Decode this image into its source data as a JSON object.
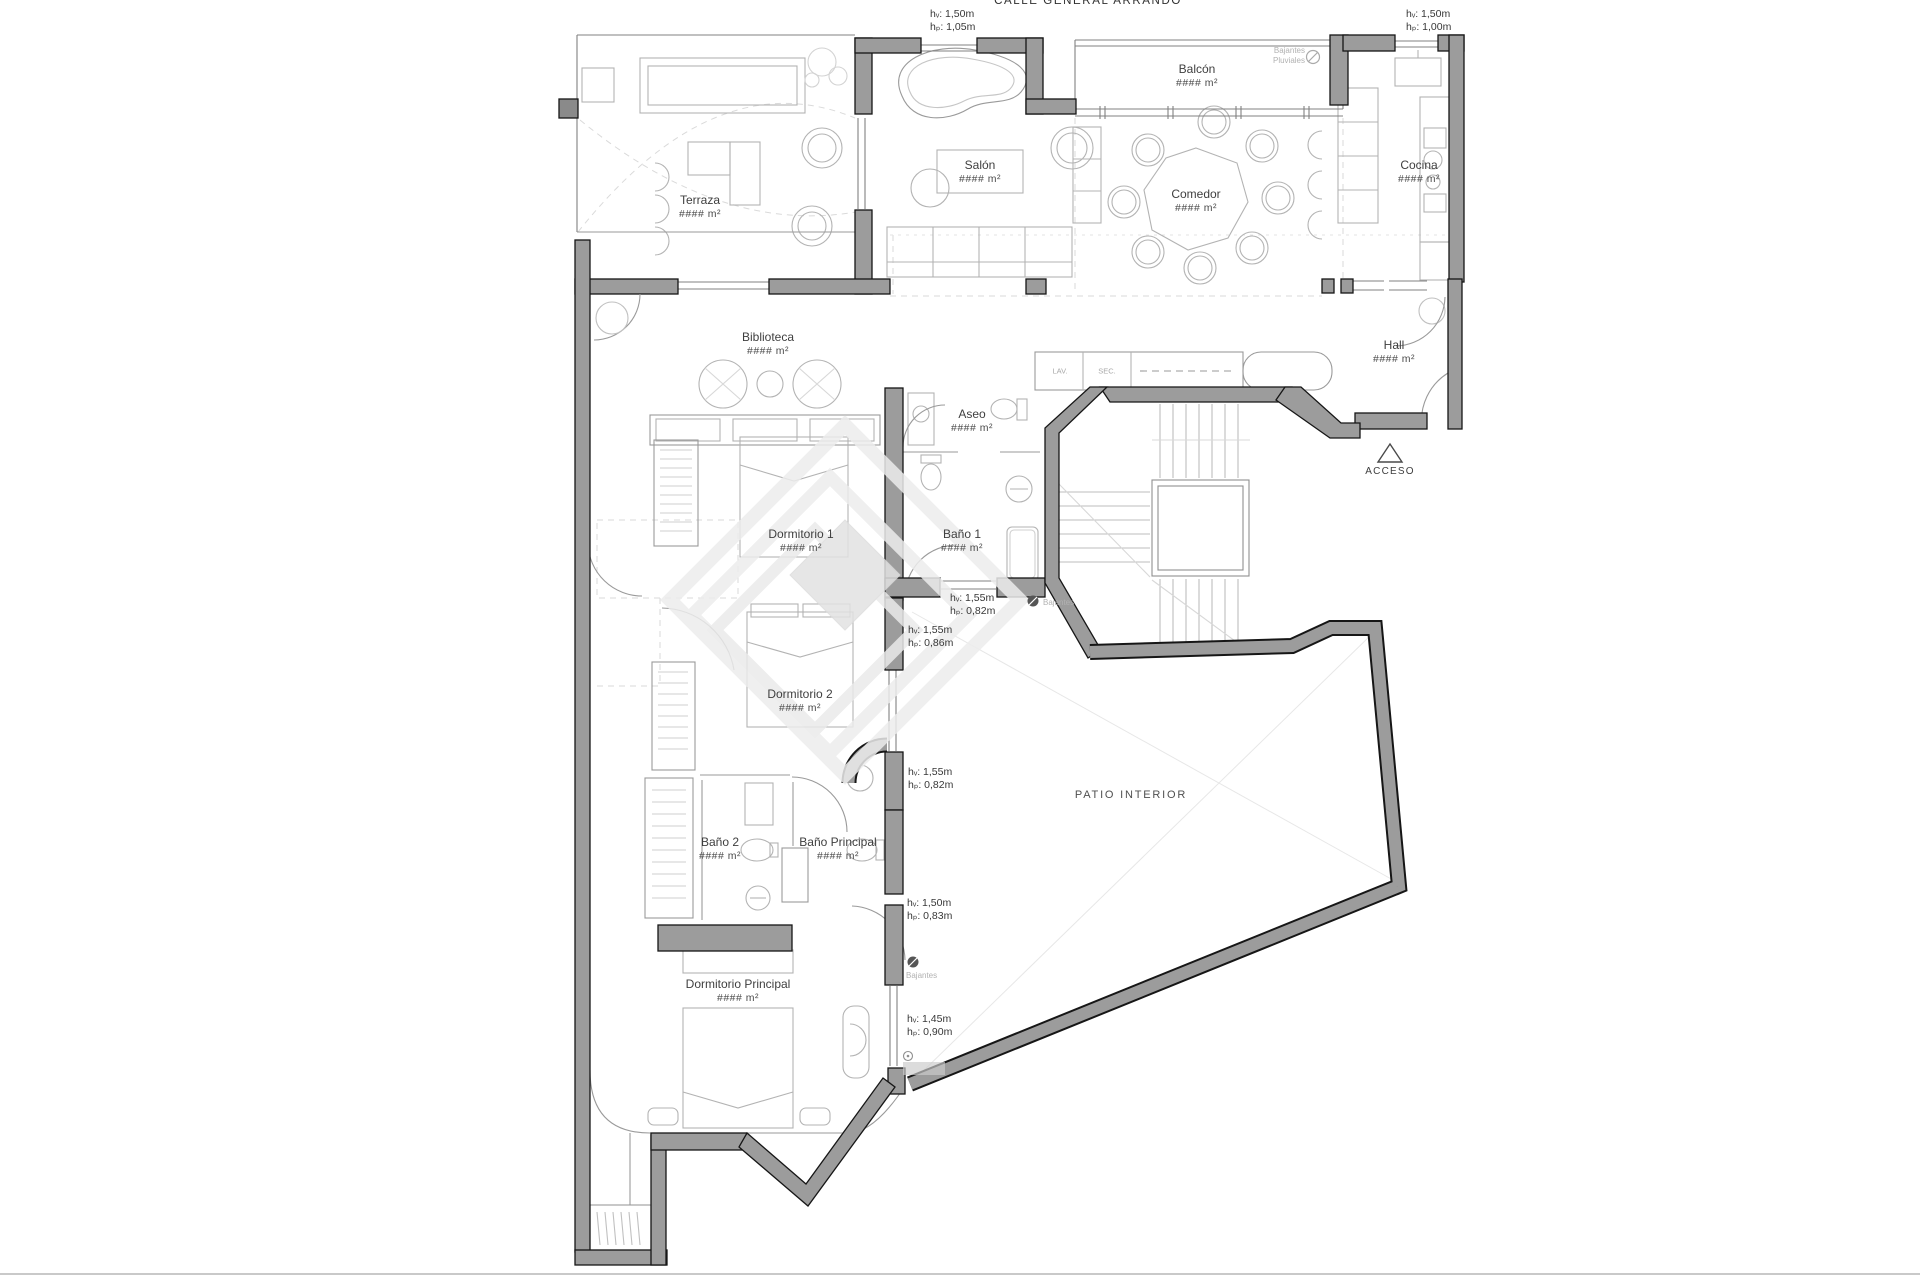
{
  "title": "CALLE GENERAL ARRANDO",
  "area_placeholder": "#### m²",
  "rooms": [
    {
      "name": "Terraza",
      "area": "#### m²"
    },
    {
      "name": "Salón",
      "area": "#### m²"
    },
    {
      "name": "Balcón",
      "area": "#### m²"
    },
    {
      "name": "Comedor",
      "area": "#### m²"
    },
    {
      "name": "Cocina",
      "area": "#### m²"
    },
    {
      "name": "Biblioteca",
      "area": "#### m²"
    },
    {
      "name": "Hall",
      "area": "#### m²"
    },
    {
      "name": "Aseo",
      "area": "#### m²"
    },
    {
      "name": "Dormitorio 1",
      "area": "#### m²"
    },
    {
      "name": "Baño 1",
      "area": "#### m²"
    },
    {
      "name": "Dormitorio 2",
      "area": "#### m²"
    },
    {
      "name": "Baño 2",
      "area": "#### m²"
    },
    {
      "name": "Baño Principal",
      "area": "#### m²"
    },
    {
      "name": "Dormitorio Principal",
      "area": "#### m²"
    }
  ],
  "patio_label": "PATIO INTERIOR",
  "closets": {
    "lav": "LAV.",
    "sec": "SEC."
  },
  "acceso_label": "ACCESO",
  "bajantes_label": "Bajantes",
  "pluviales_label": "Pluviales",
  "annotations": [
    {
      "l1": "hᵥ: 1,50m",
      "l2": "hₚ: 1,05m"
    },
    {
      "l1": "hᵥ: 1,50m",
      "l2": "hₚ: 1,00m"
    },
    {
      "l1": "hᵥ: 1,55m",
      "l2": "hₚ: 0,82m"
    },
    {
      "l1": "hᵥ: 1,55m",
      "l2": "hₚ: 0,86m"
    },
    {
      "l1": "hᵥ: 1,55m",
      "l2": "hₚ: 0,82m"
    },
    {
      "l1": "hᵥ: 1,50m",
      "l2": "hₚ: 0,83m"
    },
    {
      "l1": "hᵥ: 1,45m",
      "l2": "hₚ: 0,90m"
    }
  ],
  "colors": {
    "wall_fill": "#9c9c9c",
    "wall_edge": "#161616",
    "thin_line": "#8a8a8a",
    "furniture": "#b3b3b3",
    "dashed": "#d9d9d9",
    "watermark": "#ececec",
    "text": "#3f3f3f"
  }
}
